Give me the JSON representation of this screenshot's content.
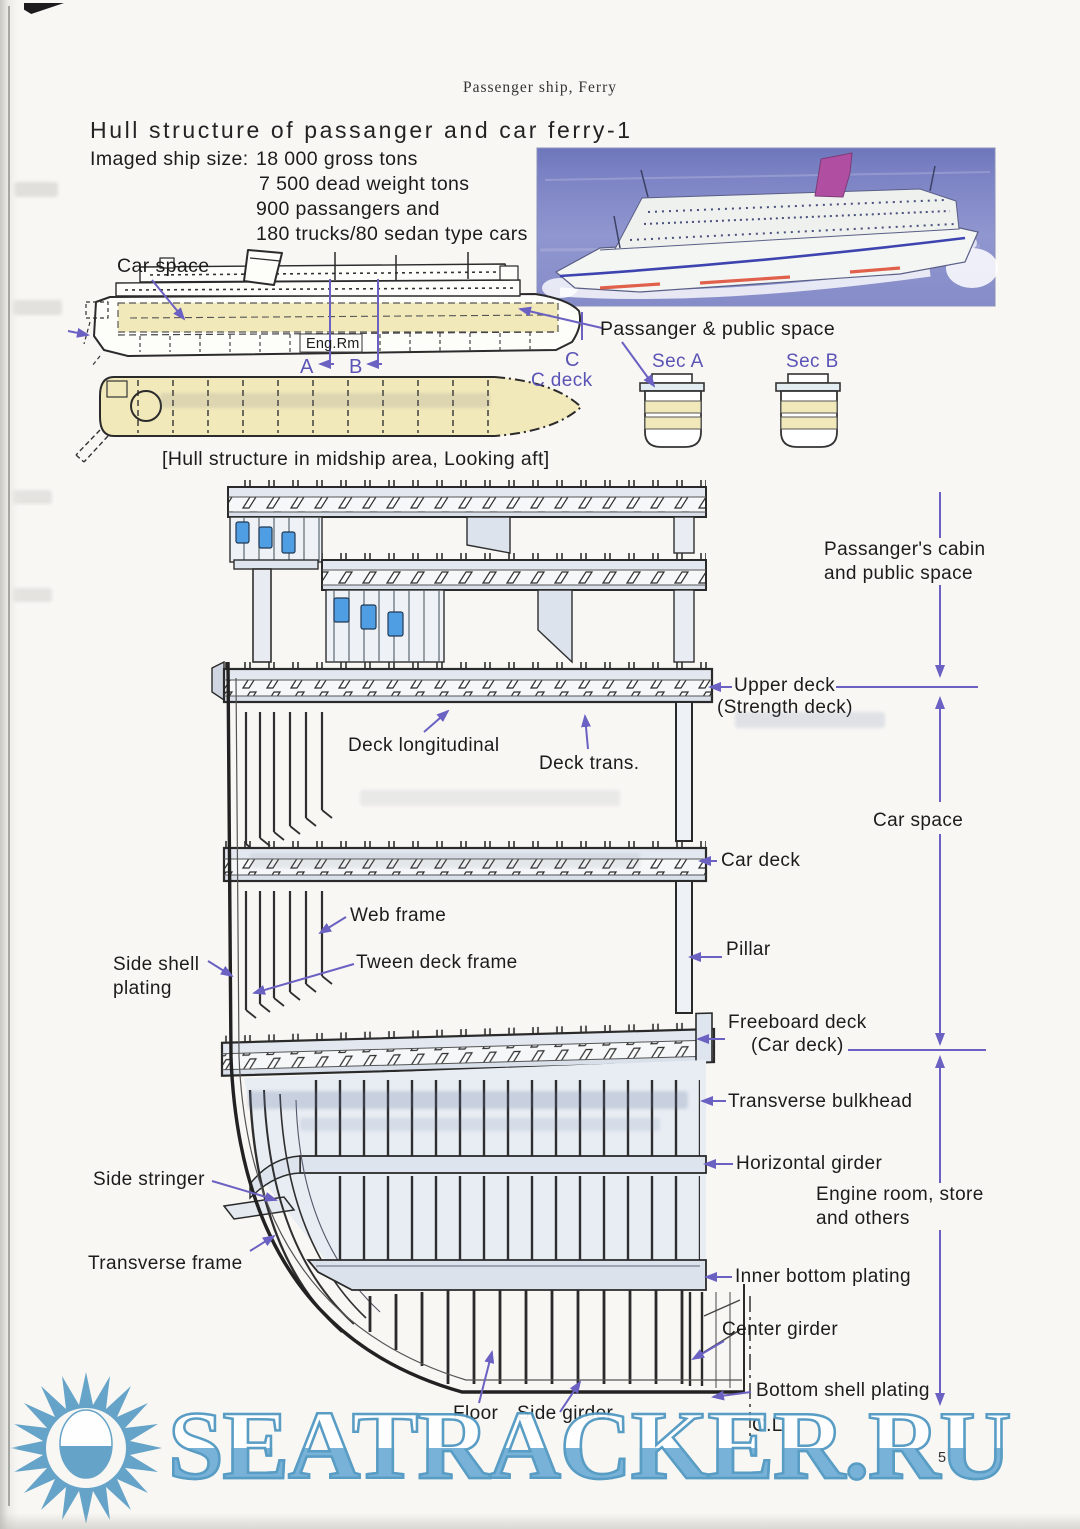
{
  "header": {
    "running_title": "Passenger ship, Ferry",
    "page_number": "5"
  },
  "title": "Hull structure of passanger and car ferry-1",
  "ship_size": {
    "label": "Imaged ship size:",
    "line1": "18 000 gross tons",
    "line2": "7 500 dead weight tons",
    "line3": "900 passangers and",
    "line4": "180 trucks/80 sedan type cars"
  },
  "profile": {
    "car_space": "Car space",
    "eng_rm": "Eng.Rm",
    "passanger_public_space": "Passanger & public space",
    "sec_a": "Sec A",
    "sec_b": "Sec B",
    "section_a": "A",
    "section_b": "B",
    "section_c": "C",
    "c_deck": "C deck",
    "caption": "[Hull structure in midship area, Looking aft]"
  },
  "section": {
    "passangers_cabin": "Passanger's cabin\nand public space",
    "upper_deck": "Upper deck",
    "strength_deck": "(Strength deck)",
    "deck_longitudinal": "Deck longitudinal",
    "deck_trans": "Deck trans.",
    "car_space": "Car space",
    "car_deck": "Car deck",
    "web_frame": "Web frame",
    "tween_deck_frame": "Tween deck frame",
    "side_shell_plating": "Side shell\nplating",
    "pillar": "Pillar",
    "freeboard_deck": "Freeboard deck",
    "freeboard_deck_sub": "(Car deck)",
    "transverse_bulkhead": "Transverse bulkhead",
    "horizontal_girder": "Horizontal girder",
    "engine_room": "Engine room, store\nand others",
    "side_stringer": "Side stringer",
    "transverse_frame": "Transverse frame",
    "inner_bottom_plating": "Inner bottom plating",
    "center_girder": "Center girder",
    "bottom_shell_plating": "Bottom shell plating",
    "floor": "Floor",
    "side_girder": "Side girder",
    "center_line": "C.L"
  },
  "watermark": {
    "text": "SEATRACKER.RU"
  },
  "colors": {
    "label_accent": "#5b54b6",
    "arrow_purple": "#6a61c2",
    "hull_yellow": "#f2e9bb",
    "window_blue": "#4f9de2",
    "watermark_blue": "#6fadd6"
  }
}
